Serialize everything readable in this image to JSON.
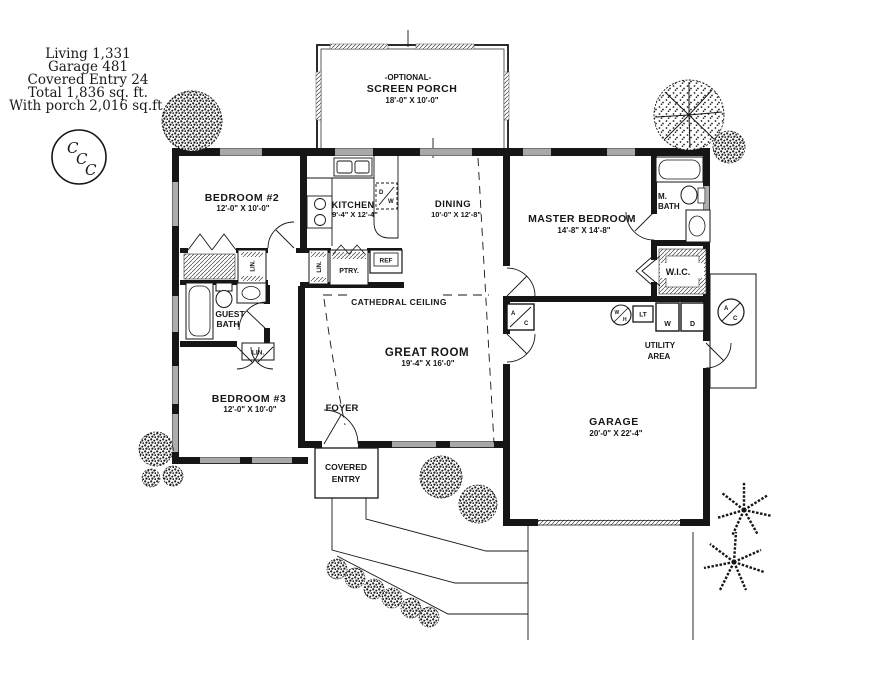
{
  "title_block": {
    "line1": "Living 1,331",
    "line2": "Garage 481",
    "line3": "Covered Entry 24",
    "line4": "Total 1,836 sq. ft.",
    "line5": "With porch 2,016 sq.ft."
  },
  "logo": {
    "c1": "C",
    "c2": "C",
    "c3": "C"
  },
  "porch": {
    "tag": "-OPTIONAL-",
    "name": "SCREEN PORCH",
    "dims": "18'-0\" X 10'-0\""
  },
  "rooms": {
    "bedroom2": {
      "name": "BEDROOM #2",
      "dims": "12'-0\" X 10'-0\""
    },
    "kitchen": {
      "name": "KITCHEN",
      "dims": "9'-4\" X 12'-4\""
    },
    "dining": {
      "name": "DINING",
      "dims": "10'-0\" X 12'-8\""
    },
    "master": {
      "name": "MASTER BEDROOM",
      "dims": "14'-8\" X 14'-8\""
    },
    "great": {
      "name": "GREAT ROOM",
      "dims": "19'-4\" X 16'-0\""
    },
    "bedroom3": {
      "name": "BEDROOM #3",
      "dims": "12'-0\" X 10'-0\""
    },
    "garage": {
      "name": "GARAGE",
      "dims": "20'-0\" X 22'-4\""
    },
    "mbath_l1": "M.",
    "mbath_l2": "BATH",
    "wic": "W.I.C.",
    "guest_l1": "GUEST",
    "guest_l2": "BATH",
    "foyer": "FOYER",
    "covered_l1": "COVERED",
    "covered_l2": "ENTRY",
    "utility_l1": "UTILITY",
    "utility_l2": "AREA"
  },
  "annotations": {
    "cathedral": "CATHEDRAL CEILING"
  },
  "fixtures": {
    "lin": "LIN.",
    "ptry": "PTRY.",
    "ref": "REF",
    "washer": "W",
    "dryer": "D",
    "laundry_tub": "LT",
    "wh_w": "W",
    "wh_h": "H",
    "ac_a": "A",
    "ac_c": "C",
    "dw_d": "D",
    "dw_w": "W"
  },
  "colors": {
    "ink": "#161616",
    "hatch": "#555555"
  }
}
